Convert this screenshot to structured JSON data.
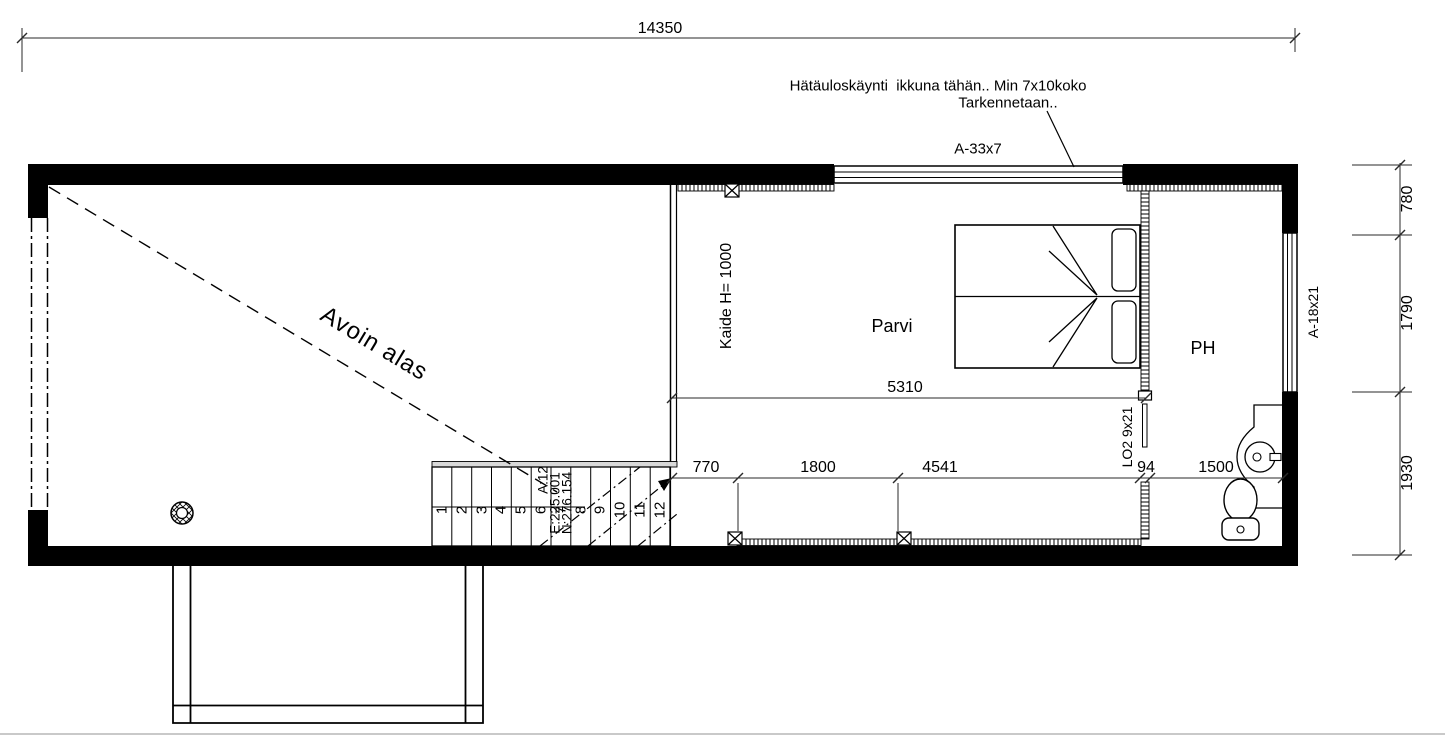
{
  "plan": {
    "annotation": {
      "line1": "Hätäuloskäynti  ikkuna tähän.. Min 7x10koko",
      "line2": "Tarkennetaan.."
    },
    "rooms": {
      "parvi": "Parvi",
      "ph": "PH",
      "open_below": "Avoin alas"
    },
    "openings": {
      "window_top": "A-33x7",
      "window_right": "A-18x21",
      "door": "LO2 9x21"
    },
    "railing_label": "Kaide H= 1000",
    "dimensions": {
      "total_width": "14350",
      "parvi_width": "5310",
      "bottom": [
        "770",
        "1800",
        "4541",
        "94",
        "1500"
      ],
      "right": [
        "780",
        "1790",
        "1930"
      ]
    },
    "stairs": {
      "numbers": [
        "1",
        "2",
        "3",
        "4",
        "5",
        "6",
        "7",
        "8",
        "9",
        "10",
        "11",
        "12"
      ],
      "info": [
        "A:12",
        "E:225.001",
        "N:276.154"
      ]
    }
  }
}
